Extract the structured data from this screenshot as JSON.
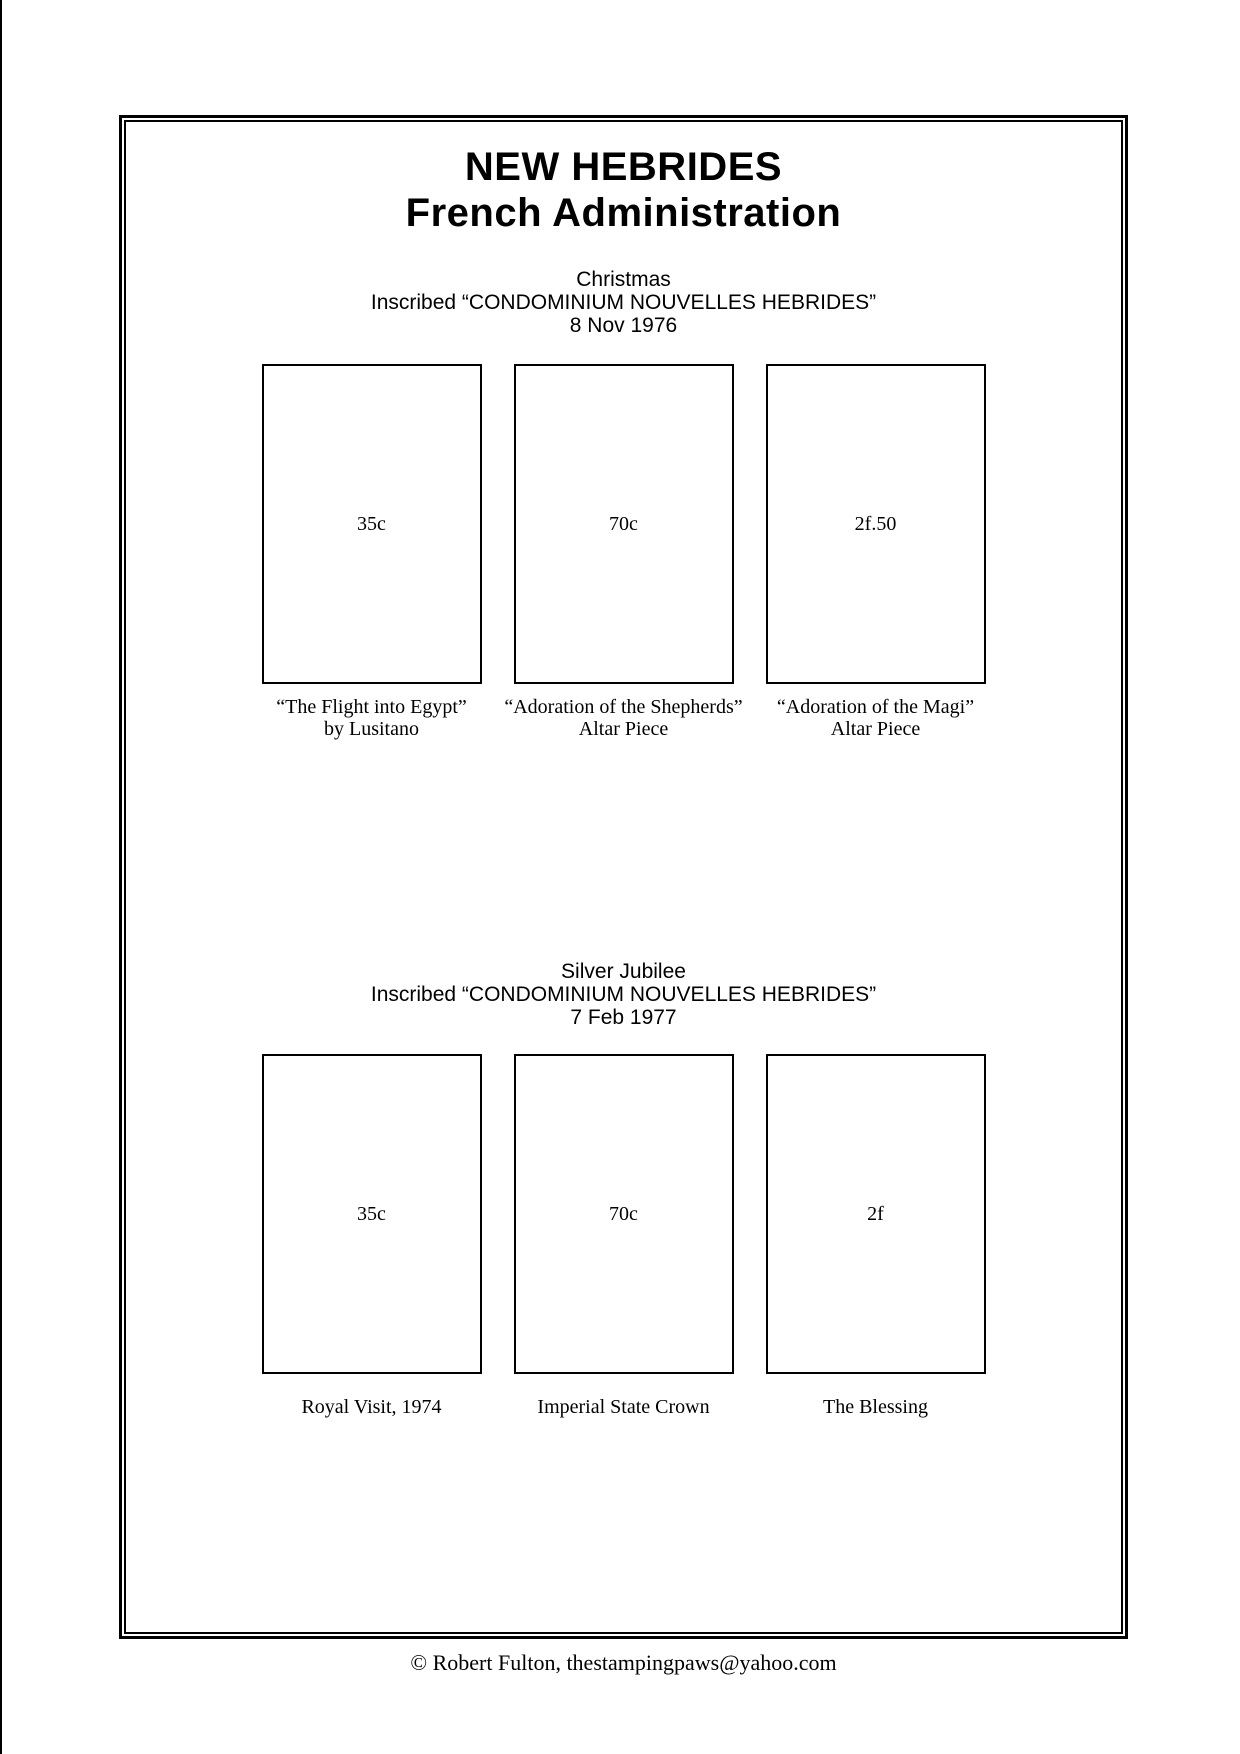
{
  "page": {
    "title_line1": "NEW HEBRIDES",
    "title_line2": "French Administration",
    "footer": "©  Robert Fulton, thestampingpaws@yahoo.com"
  },
  "colors": {
    "ink": "#000000",
    "background": "#ffffff"
  },
  "sections": [
    {
      "heading": "Christmas",
      "inscription": "Inscribed “CONDOMINIUM NOUVELLES HEBRIDES”",
      "date": "8 Nov 1976",
      "stamps": [
        {
          "value": "35c",
          "caption_line1": "“The Flight into Egypt”",
          "caption_line2": "by Lusitano"
        },
        {
          "value": "70c",
          "caption_line1": "“Adoration of the Shepherds”",
          "caption_line2": "Altar Piece"
        },
        {
          "value": "2f.50",
          "caption_line1": "“Adoration of the Magi”",
          "caption_line2": "Altar Piece"
        }
      ]
    },
    {
      "heading": "Silver Jubilee",
      "inscription": "Inscribed “CONDOMINIUM NOUVELLES HEBRIDES”",
      "date": "7 Feb 1977",
      "stamps": [
        {
          "value": "35c",
          "caption_line1": "Royal Visit, 1974",
          "caption_line2": ""
        },
        {
          "value": "70c",
          "caption_line1": "Imperial State Crown",
          "caption_line2": ""
        },
        {
          "value": "2f",
          "caption_line1": "The Blessing",
          "caption_line2": ""
        }
      ]
    }
  ]
}
